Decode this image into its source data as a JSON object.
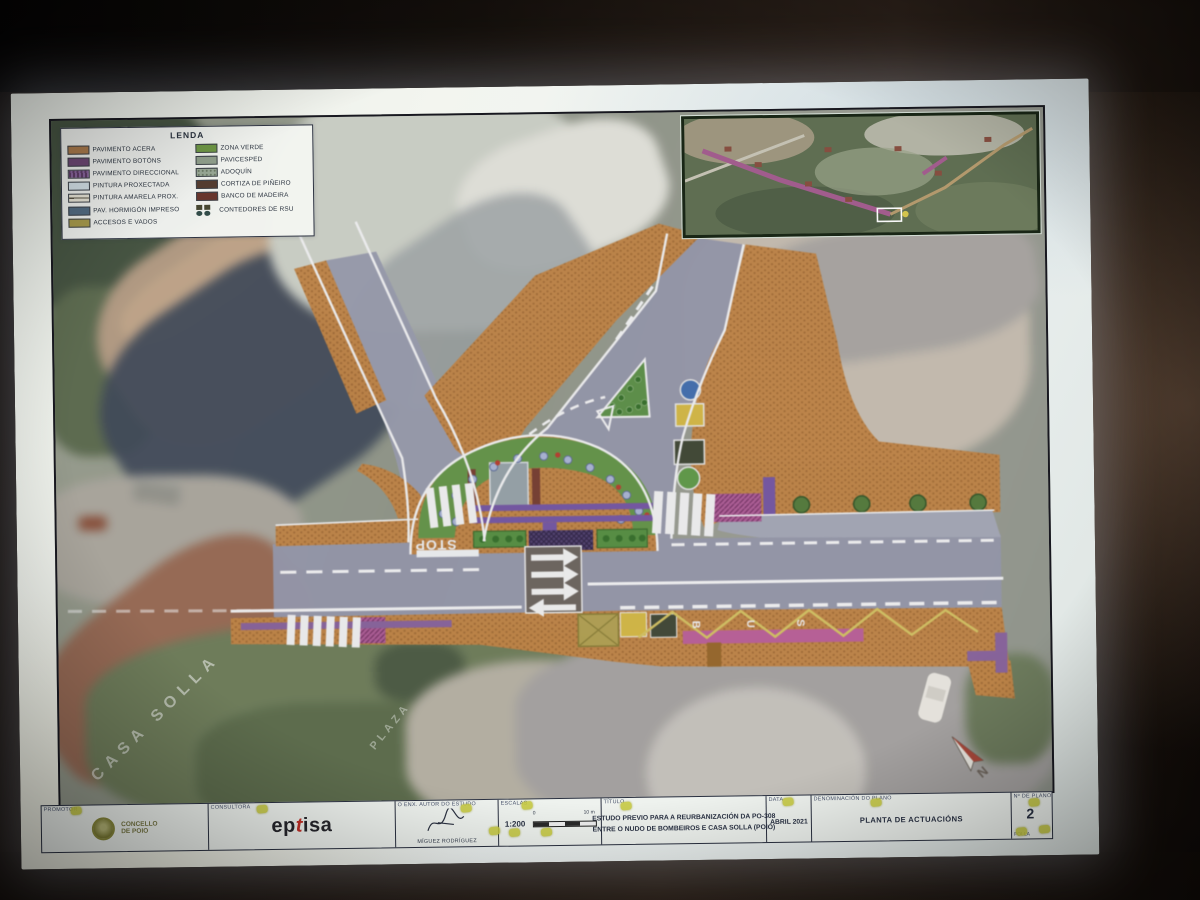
{
  "legend": {
    "title": "LENDA",
    "items_left": [
      {
        "label": "PAVIMENTO ACERA",
        "color": "#b17a45"
      },
      {
        "label": "PAVIMENTO BOTÓNS",
        "color": "#6f4478"
      },
      {
        "label": "PAVIMENTO DIRECCIONAL",
        "color": "#5e3a68"
      },
      {
        "label": "PINTURA PROXECTADA",
        "color": "#d7e6ee"
      },
      {
        "label": "PINTURA AMARELA PROX.",
        "color": "#ece8d8"
      },
      {
        "label": "PAV. HORMIGÓN IMPRESO",
        "color": "#4e6a84"
      },
      {
        "label": "ACCESOS E VADOS",
        "color": "#a89a40"
      }
    ],
    "items_right": [
      {
        "label": "ZONA VERDE",
        "color": "#6b9a3c"
      },
      {
        "label": "PAVICESPED",
        "color": "#8fa08a"
      },
      {
        "label": "ADOQUÍN",
        "color": "#97a894"
      },
      {
        "label": "CORTIZA DE PIÑEIRO",
        "color": "#54382a"
      },
      {
        "label": "BANCO DE MADEIRA",
        "color": "#6b3026"
      },
      {
        "label": "CONTEDORES DE RSU",
        "color": "#3a3a32"
      }
    ]
  },
  "map": {
    "stop": "STOP",
    "bus": [
      "B",
      "U",
      "S"
    ],
    "casa_solla": "CASA SOLLA",
    "plaza": "PLAZA",
    "north": "N"
  },
  "titleblock": {
    "promotor_label": "PROMOTOR",
    "promotor_line1": "CONCELLO",
    "promotor_line2": "DE POIO",
    "consultora_label": "CONSULTORA",
    "consultora_logo": [
      "ep",
      "t",
      "isa"
    ],
    "author_label": "O ENX. AUTOR DO ESTUDO",
    "author_name": "MÍGUEZ RODRÍGUEZ",
    "scale_label": "ESCALAS",
    "scale_value": "1:200",
    "scale_ticks": [
      "0",
      "10 m"
    ],
    "title_label": "TÍTULO",
    "title_line1": "ESTUDO PREVIO PARA A REURBANIZACIÓN DA PO-308",
    "title_line2": "ENTRE O NUDO DE BOMBEIROS E CASA SOLLA (POIO)",
    "date_label": "DATA",
    "date_value": "ABRIL 2021",
    "plan_label": "DENOMINACIÓN DO PLANO",
    "plan_name": "PLANTA DE ACTUACIÓNS",
    "number_label": "Nº DE PLANO",
    "number_value": "2",
    "sheet_label": "FOLLA"
  }
}
